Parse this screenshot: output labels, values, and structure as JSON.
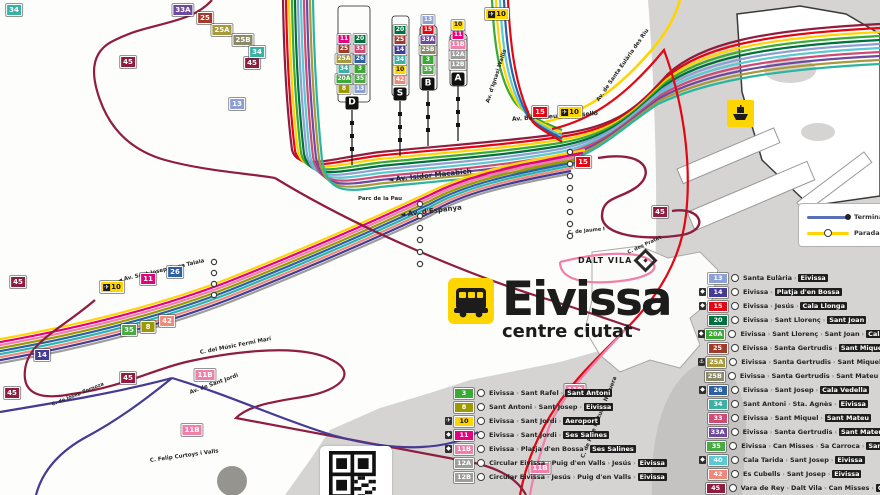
{
  "title": {
    "name": "Eivissa",
    "subtitle": "centre ciutat"
  },
  "labels": {
    "dalt_vila": "DALT VILA"
  },
  "legend_box": {
    "terminal": "Terminal",
    "parada": "Parada"
  },
  "line_colors": {
    "3": "#3aaa35",
    "8": "#9c9a00",
    "10": "#ffd500",
    "11": "#e6007e",
    "11B": "#f07fa9",
    "12A": "#9d9d9c",
    "12B": "#9d9d9c",
    "13": "#8e9fd4",
    "14": "#453a94",
    "15": "#e30613",
    "20": "#00703c",
    "20A": "#3aaa35",
    "25": "#a33b2a",
    "25A": "#a89a3c",
    "25B": "#8a8a6a",
    "26": "#2e5fa3",
    "33": "#cf4a75",
    "33A": "#6d4a9e",
    "34": "#3bb1a5",
    "35": "#49a942",
    "40": "#5bc8d2",
    "42": "#ef8a7a",
    "45": "#8f1d3f"
  },
  "right_legend": [
    {
      "line": "13",
      "icon": null,
      "stops": [
        "Santa Eulària",
        "Eivissa"
      ]
    },
    {
      "line": "14",
      "icon": "beach",
      "stops": [
        "Eivissa",
        "Platja d'en Bossa"
      ]
    },
    {
      "line": "15",
      "icon": "beach",
      "stops": [
        "Eivissa",
        "Jesús",
        "Cala Llonga"
      ]
    },
    {
      "line": "20",
      "icon": null,
      "stops": [
        "Eivissa",
        "Sant Llorenç",
        "Sant Joan"
      ]
    },
    {
      "line": "20A",
      "icon": "beach",
      "stops": [
        "Eivissa",
        "Sant Llorenç",
        "Sant Joan",
        "Cala Portinatx"
      ]
    },
    {
      "line": "25",
      "icon": null,
      "stops": [
        "Eivissa",
        "Santa Gertrudis",
        "Sant Miquel"
      ]
    },
    {
      "line": "25A",
      "icon": "port",
      "stops": [
        "Eivissa",
        "Santa Gertrudis",
        "Sant Miquel",
        "Port"
      ]
    },
    {
      "line": "25B",
      "icon": null,
      "stops": [
        "Eivissa",
        "Santa Gertrudis",
        "Sant Mateu",
        "Santa Agnès"
      ]
    },
    {
      "line": "26",
      "icon": "beach",
      "stops": [
        "Eivissa",
        "Sant Josep",
        "Cala Vedella"
      ]
    },
    {
      "line": "34",
      "icon": null,
      "stops": [
        "Sant Antoni",
        "Sta. Agnès",
        "Eivissa"
      ]
    },
    {
      "line": "33",
      "icon": null,
      "stops": [
        "Eivissa",
        "Sant Miquel",
        "Sant Mateu"
      ]
    },
    {
      "line": "33A",
      "icon": null,
      "stops": [
        "Eivissa",
        "Santa Gertrudis",
        "Sant Mateu"
      ]
    },
    {
      "line": "35",
      "icon": null,
      "stops": [
        "Eivissa",
        "Can Misses",
        "Sa Carroca",
        "Sant Jordi"
      ]
    },
    {
      "line": "40",
      "icon": "beach",
      "stops": [
        "Cala Tarida",
        "Sant Josep",
        "Eivissa"
      ]
    },
    {
      "line": "42",
      "icon": null,
      "stops": [
        "Es Cubells",
        "Sant Josep",
        "Eivissa"
      ]
    },
    {
      "line": "45",
      "icon": null,
      "stops": [
        "Vara de Rey",
        "Dalt Vila",
        "Can Misses",
        "Cas Serres"
      ]
    }
  ],
  "bottom_legend": [
    {
      "line": "3",
      "icon": null,
      "stops": [
        "Eivissa",
        "Sant Rafel",
        "Sant Antoni"
      ]
    },
    {
      "line": "8",
      "icon": null,
      "stops": [
        "Sant Antoni",
        "Sant Josep",
        "Eivissa"
      ]
    },
    {
      "line": "10",
      "icon": "plane",
      "stops": [
        "Eivissa",
        "Sant Jordi",
        "Aeroport"
      ]
    },
    {
      "line": "11",
      "icon": "beach",
      "stops": [
        "Eivissa",
        "Sant Jordi",
        "Ses Salines"
      ]
    },
    {
      "line": "11B",
      "icon": "beach",
      "stops": [
        "Eivissa",
        "Platja d'en Bossa",
        "Ses Salines"
      ]
    },
    {
      "line": "12A",
      "icon": null,
      "stops": [
        "Circular Eivissa",
        "Puig d'en Valls",
        "Jesús",
        "Eivissa"
      ]
    },
    {
      "line": "12B",
      "icon": null,
      "stops": [
        "Circular Eivissa",
        "Jesús",
        "Puig d'en Valls",
        "Eivissa"
      ]
    }
  ],
  "map": {
    "badges": [
      {
        "x": 128,
        "y": 62,
        "l": "45"
      },
      {
        "x": 18,
        "y": 282,
        "l": "45"
      },
      {
        "x": 12,
        "y": 393,
        "l": "45"
      },
      {
        "x": 128,
        "y": 378,
        "l": "45"
      },
      {
        "x": 660,
        "y": 212,
        "l": "45"
      },
      {
        "x": 252,
        "y": 63,
        "l": "45"
      },
      {
        "x": 583,
        "y": 162,
        "l": "15"
      },
      {
        "x": 540,
        "y": 112,
        "l": "15"
      },
      {
        "x": 570,
        "y": 112,
        "l": "10",
        "icon": "plane"
      },
      {
        "x": 497,
        "y": 14,
        "l": "10",
        "icon": "plane"
      },
      {
        "x": 112,
        "y": 287,
        "l": "10",
        "icon": "plane"
      },
      {
        "x": 148,
        "y": 279,
        "l": "11"
      },
      {
        "x": 175,
        "y": 272,
        "l": "26"
      },
      {
        "x": 148,
        "y": 327,
        "l": "8"
      },
      {
        "x": 129,
        "y": 330,
        "l": "35"
      },
      {
        "x": 167,
        "y": 321,
        "l": "42"
      },
      {
        "x": 42,
        "y": 355,
        "l": "14"
      },
      {
        "x": 205,
        "y": 375,
        "l": "11B"
      },
      {
        "x": 192,
        "y": 430,
        "l": "11B"
      },
      {
        "x": 540,
        "y": 468,
        "l": "11B"
      },
      {
        "x": 575,
        "y": 390,
        "l": "11B"
      },
      {
        "x": 237,
        "y": 104,
        "l": "13"
      },
      {
        "x": 183,
        "y": 10,
        "l": "33A"
      },
      {
        "x": 205,
        "y": 18,
        "l": "25"
      },
      {
        "x": 222,
        "y": 30,
        "l": "25A"
      },
      {
        "x": 243,
        "y": 40,
        "l": "25B"
      },
      {
        "x": 257,
        "y": 52,
        "l": "34"
      },
      {
        "x": 14,
        "y": 10,
        "l": "34"
      }
    ],
    "streets": [
      {
        "t": "◄ Av. Isidor Macabich",
        "x": 388,
        "y": 176,
        "r": -6,
        "s": 7
      },
      {
        "t": "Parc de la Pau",
        "x": 358,
        "y": 196,
        "r": 0,
        "s": 5.5
      },
      {
        "t": "◄ Av. d'Espanya",
        "x": 400,
        "y": 211,
        "r": -7,
        "s": 7
      },
      {
        "t": "Av. Bartomeu de Rosselló",
        "x": 512,
        "y": 116,
        "r": -4,
        "s": 6
      },
      {
        "t": "Av. de Santa Eulària des Riu",
        "x": 598,
        "y": 98,
        "r": -55,
        "s": 5.5
      },
      {
        "t": "Av. d'Ignasi Wallis",
        "x": 488,
        "y": 100,
        "r": -72,
        "s": 5.5
      },
      {
        "t": "◄ Av. Sant Josep de sa Talaia",
        "x": 118,
        "y": 278,
        "r": -13,
        "s": 5.5
      },
      {
        "t": "C. del Músic Fermí Marí",
        "x": 200,
        "y": 350,
        "r": -11,
        "s": 5.5
      },
      {
        "t": "Av. de Sant Jordi",
        "x": 190,
        "y": 390,
        "r": -20,
        "s": 5.5
      },
      {
        "t": "C. Felip Curtoys i Valls",
        "x": 150,
        "y": 458,
        "r": -8,
        "s": 5.5
      },
      {
        "t": "C. de Pere Matutes Noguera",
        "x": 583,
        "y": 455,
        "r": -68,
        "s": 5.5
      },
      {
        "t": "C. des Pratet",
        "x": 628,
        "y": 250,
        "r": -25,
        "s": 5
      },
      {
        "t": "C. de Jaume I",
        "x": 568,
        "y": 230,
        "r": -6,
        "s": 5
      },
      {
        "t": "C. de Josep Zornoza",
        "x": 52,
        "y": 402,
        "r": -22,
        "s": 5
      }
    ],
    "platforms": [
      {
        "letter": "D",
        "x": 352,
        "y": 103,
        "cols": 2,
        "stack": [
          [
            "8",
            "13"
          ],
          [
            "20A",
            "35"
          ],
          [
            "34",
            "3"
          ],
          [
            "25A",
            "26"
          ],
          [
            "25",
            "33"
          ],
          [
            "11",
            "20"
          ]
        ]
      },
      {
        "letter": "S",
        "x": 400,
        "y": 94,
        "cols": 1,
        "stack": [
          [
            "42"
          ],
          [
            "10"
          ],
          [
            "34"
          ],
          [
            "14"
          ],
          [
            "25"
          ],
          [
            "20"
          ]
        ]
      },
      {
        "letter": "B",
        "x": 428,
        "y": 84,
        "cols": 1,
        "stack": [
          [
            "35"
          ],
          [
            "3"
          ],
          [
            "25B"
          ],
          [
            "33A"
          ],
          [
            "15"
          ],
          [
            "13"
          ]
        ]
      },
      {
        "letter": "A",
        "x": 458,
        "y": 79,
        "cols": 1,
        "stack": [
          [
            "12B"
          ],
          [
            "12A"
          ],
          [
            "11B"
          ],
          [
            "11"
          ],
          [
            "10"
          ]
        ]
      }
    ],
    "stop_chains": [
      {
        "x": 420,
        "y0": 204,
        "n": 6,
        "step": 12
      },
      {
        "x": 570,
        "y0": 152,
        "n": 8,
        "step": 12
      },
      {
        "x": 214,
        "y0": 262,
        "n": 4,
        "step": 11
      }
    ]
  }
}
